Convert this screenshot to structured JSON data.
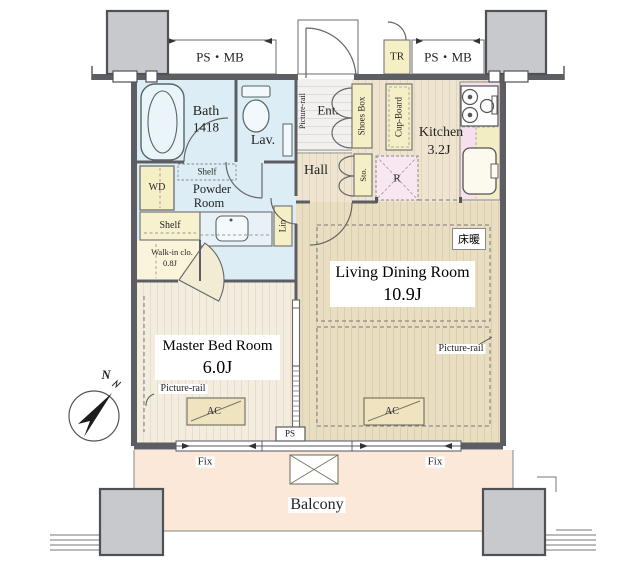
{
  "corridor": {
    "ps_mb_left": "PS・MB",
    "tr": "TR",
    "ps_mb_right": "PS・MB"
  },
  "bath": {
    "name": "Bath",
    "size": "1418"
  },
  "lav": {
    "name": "Lav."
  },
  "powder": {
    "wd": "WD",
    "shelf_upper": "Shelf",
    "name_line1": "Powder",
    "name_line2": "Room",
    "shelf_lower": "Shelf",
    "lin": "Lin"
  },
  "walkin": {
    "name": "Walk-in clo.",
    "size": "0.8J"
  },
  "entrance": {
    "picture_rail": "Picture-rail",
    "name": "Ent.",
    "shoes_box": "Shoes Box"
  },
  "hall": {
    "name": "Hall",
    "sto": "Sto."
  },
  "kitchen": {
    "name": "Kitchen",
    "size": "3.2J",
    "cup_board": "Cup-Board",
    "fridge": "R"
  },
  "living": {
    "floor_heating": "床暖",
    "name": "Living Dining Room",
    "size": "10.9J",
    "picture_rail": "Picture-rail",
    "ac": "AC"
  },
  "bedroom": {
    "name": "Master Bed Room",
    "size": "6.0J",
    "picture_rail": "Picture-rail",
    "ac": "AC"
  },
  "south": {
    "ps": "PS",
    "fix_left": "Fix",
    "fix_right": "Fix",
    "balcony": "Balcony"
  },
  "compass": {
    "north": "N"
  },
  "colors": {
    "wall": "#5d5e63",
    "pillar": "#c8c9cc",
    "wet_area": "#ddedf5",
    "cabinet": "#f5efc5",
    "kitchen_counter": "#f6e0ec",
    "balcony": "#fbe8d9",
    "wood_living": "#e9ddc2",
    "wood_bedroom": "#f2edde"
  }
}
